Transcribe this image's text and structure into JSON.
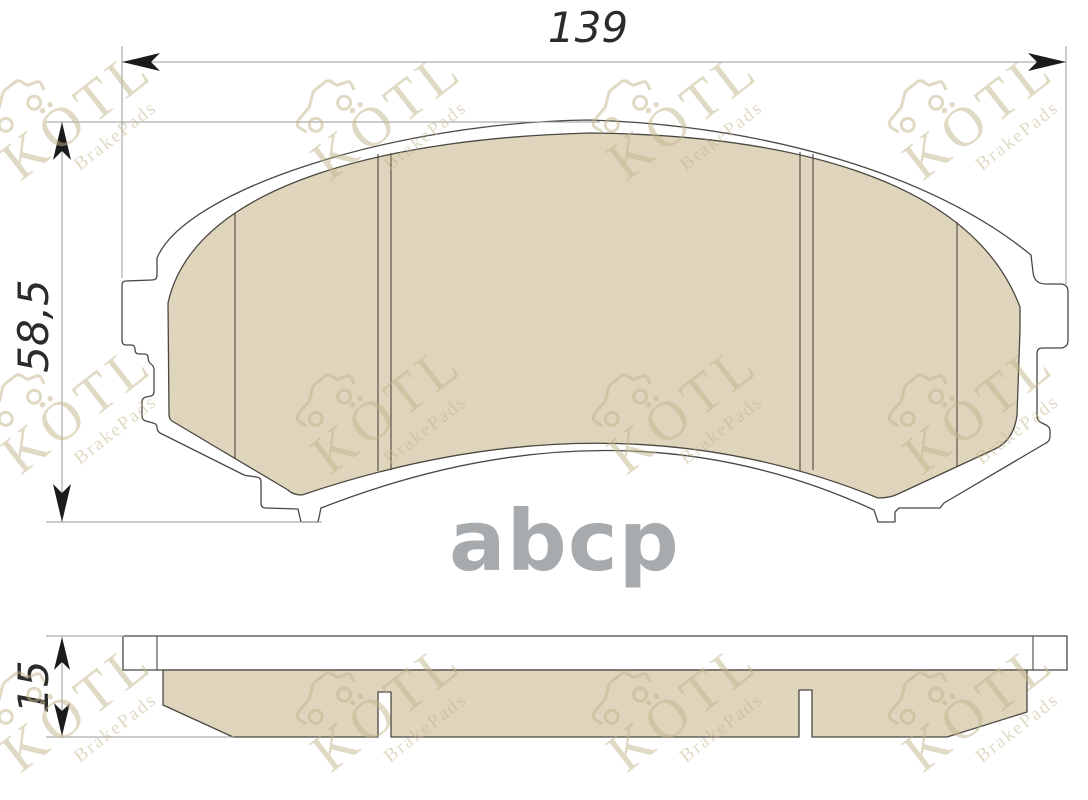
{
  "watermark": {
    "brand": "KÖTL",
    "subtitle": "BrakePads",
    "logo_center": "abcp",
    "grid": {
      "xs": [
        -18,
        292,
        588,
        884
      ],
      "ys": [
        38,
        332,
        630
      ],
      "angle_deg": -38
    }
  },
  "dimensions": {
    "width": "139",
    "height": "58,5",
    "thickness": "15"
  },
  "colors": {
    "friction": "#ded5bc",
    "outline": "#4b4840",
    "dim_line": "#9a9a9a",
    "arrow": "#1b1b1b",
    "dim_text": "#2b2b2b",
    "watermark": "#c2b68d",
    "logo_gray": "#a7abae"
  }
}
